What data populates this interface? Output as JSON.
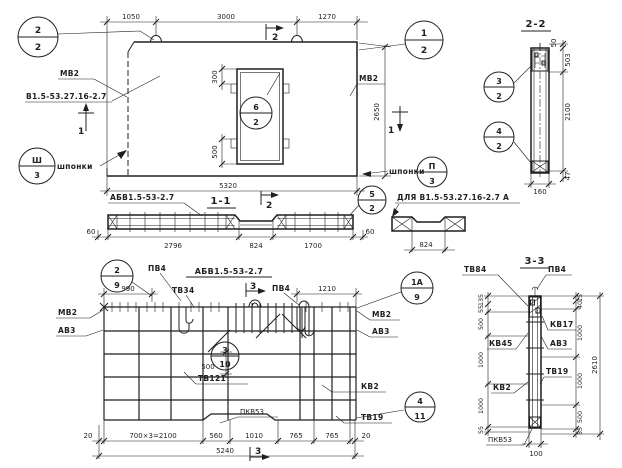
{
  "plan": {
    "dim_1050": "1050",
    "dim_3000": "3000",
    "dim_1270": "1270",
    "dim_total": "5320",
    "dim_height": "2650",
    "dim_hinge_top": "300",
    "dim_hinge_bot": "500",
    "label_mv2_left": "МВ2",
    "label_series_left": "В1.5-53.27.16-2.7",
    "label_mv2_right": "МВ2",
    "label_keys_left": "шпонки",
    "label_keys_right": "шпонки",
    "mark_sec2": "2",
    "mark_sec1_left": "1",
    "mark_sec1_right": "1"
  },
  "sec22": {
    "title": "2-2",
    "dim_50": "50",
    "dim_503": "503",
    "dim_2100": "2100",
    "dim_47": "47",
    "dim_160": "160"
  },
  "sec11": {
    "title": "1-1",
    "label_series": "АБВ1.5-53-2.7",
    "mark_sec2": "2",
    "dim_60_left": "60",
    "dim_2796": "2796",
    "dim_824": "824",
    "dim_1700": "1700",
    "dim_60_right": "60",
    "detail_label": "ДЛЯ В1.5-53.27.16-2.7 А",
    "detail_dim_824": "824"
  },
  "mesh": {
    "title": "АБВ1.5-53-2.7",
    "label_pv4_left": "ПВ4",
    "label_tv34": "ТВ34",
    "label_pv4_mid": "ПВ4",
    "dim_990": "990",
    "dim_1210": "1210",
    "mark_sec3_top": "3",
    "mark_sec3_bottom": "3",
    "label_mv2_left": "МВ2",
    "label_av3_left": "АВ3",
    "label_mv2_right": "МВ2",
    "label_av3_right": "АВ3",
    "dim_500": "500",
    "label_tv121": "ТВ121",
    "label_kv2": "КВ2",
    "label_tv19": "ТВ19",
    "label_pkv53": "ПКВ53",
    "dim_20_left": "20",
    "dim_700x3": "700×3=2100",
    "dim_560": "560",
    "dim_1010": "1010",
    "dim_765_a": "765",
    "dim_765_b": "765",
    "dim_20_right": "20",
    "dim_total": "5240"
  },
  "sec33": {
    "title": "3-3",
    "label_tv84": "ТВ84",
    "label_pv4": "ПВ4",
    "label_kv17": "КВ17",
    "label_kv45": "КВ45",
    "label_av3": "АВ3",
    "label_tv19": "ТВ19",
    "label_kv2": "КВ2",
    "label_pkv53": "ПКВ53",
    "dim_left_135": "135",
    "dim_left_55a": "55",
    "dim_left_500": "500",
    "dim_left_1000a": "1000",
    "dim_left_1000b": "1000",
    "dim_left_55b": "55",
    "dim_right_15": "15",
    "dim_right_40": "40",
    "dim_right_1000a": "1000",
    "dim_right_1000b": "1000",
    "dim_right_500": "500",
    "dim_right_55": "55",
    "dim_total": "2610",
    "dim_100": "100"
  },
  "balloons": {
    "plan_tl": {
      "top": "2",
      "bot": "2"
    },
    "plan_tr": {
      "top": "1",
      "bot": "2"
    },
    "opening": {
      "top": "6",
      "bot": "2"
    },
    "keys_left": {
      "top": "Ш",
      "bot": "3"
    },
    "keys_right": {
      "top": "П",
      "bot": "3"
    },
    "s22_top": {
      "top": "3",
      "bot": "2"
    },
    "s22_bot": {
      "top": "4",
      "bot": "2"
    },
    "s11": {
      "top": "5",
      "bot": "2"
    },
    "mesh_tl": {
      "top": "2",
      "bot": "9"
    },
    "mesh_tr": {
      "top": "1А",
      "bot": "9"
    },
    "mesh_mid": {
      "top": "3",
      "bot": "10"
    },
    "mesh_br": {
      "top": "4",
      "bot": "11"
    }
  }
}
